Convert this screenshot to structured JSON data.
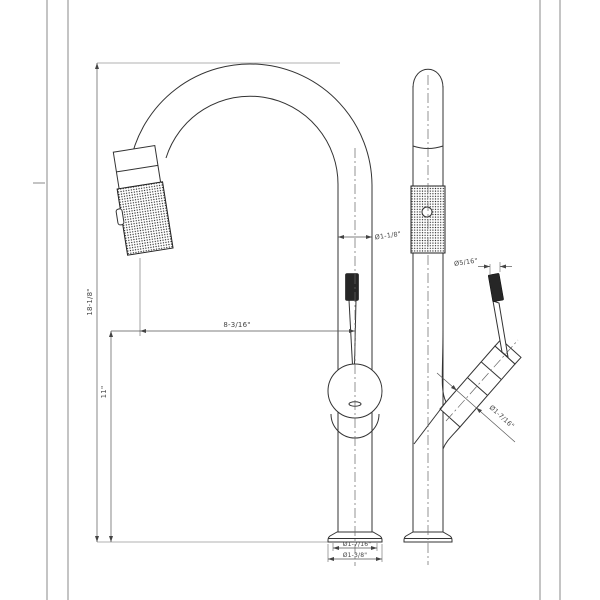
{
  "dimensions": {
    "overall_height": "18-1/8\"",
    "height_to_spout": "11\"",
    "spout_reach": "8-3/16\"",
    "spout_tube_diameter": "Ø1-1/8\"",
    "lever_tip_diameter": "Ø5/16\"",
    "handle_diameter": "Ø1-7/16\"",
    "base_upper_diameter": "Ø1-7/16\"",
    "base_lower_diameter": "Ø1-3/8\""
  },
  "colors": {
    "line": "#333333",
    "dimension_line": "#555555",
    "knurl_dark": "#1c1c1c",
    "background": "#ffffff"
  }
}
